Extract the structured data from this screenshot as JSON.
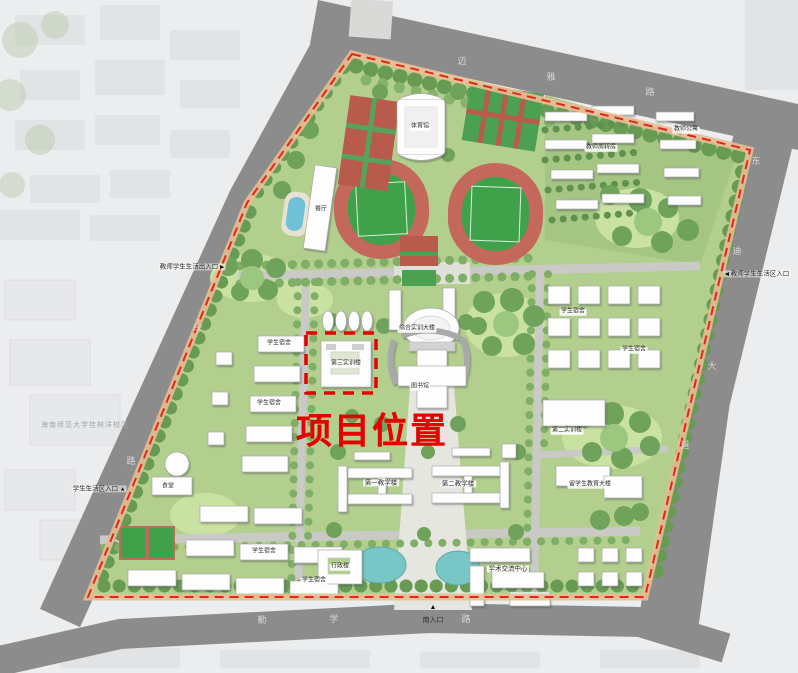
{
  "annotations": {
    "project_marker": "项目位置",
    "context_area": "海南师范大学桂林洋校区",
    "south_entrance": "南入口",
    "entrance_west": "教师学生生活出入口",
    "entrance_east": "教师学生生活区入口",
    "entrance_southwest": "学生生活区入口",
    "arrow_right": "▶",
    "arrow_left": "◀",
    "arrow_up": "▲"
  },
  "roads": {
    "top": [
      "迈",
      "雅",
      "路"
    ],
    "right": [
      "东",
      "迪",
      "大",
      "道"
    ],
    "bottom": [
      "勤",
      "学",
      "路"
    ],
    "left": [
      "学",
      "路"
    ]
  },
  "buildings": {
    "gym": "体育馆",
    "canteen": "餐厅",
    "training_main": "综合实训大楼",
    "library": "图书馆",
    "project_building": "第三实训楼",
    "teaching_1": "第一教学楼",
    "teaching_2": "第二教学楼",
    "training_2": "第二实训楼",
    "intl_edu": "留学生教育大楼",
    "admin": "行政楼",
    "academic_center": "学术交流中心",
    "dining": "食堂",
    "dorm": "学生宿舍",
    "teacher_housing": "教师周转房",
    "teacher_apt": "教师公寓"
  },
  "colors": {
    "highlight_red": "#e60000",
    "boundary_red": "#e02818",
    "boundary_path": "#e8bd93",
    "track_red": "#c4685c",
    "field_green": "#3fa24b",
    "water_blue": "#79c6c6",
    "road_gray": "#8c8c8c",
    "campus_green": "#b3cf8e"
  }
}
